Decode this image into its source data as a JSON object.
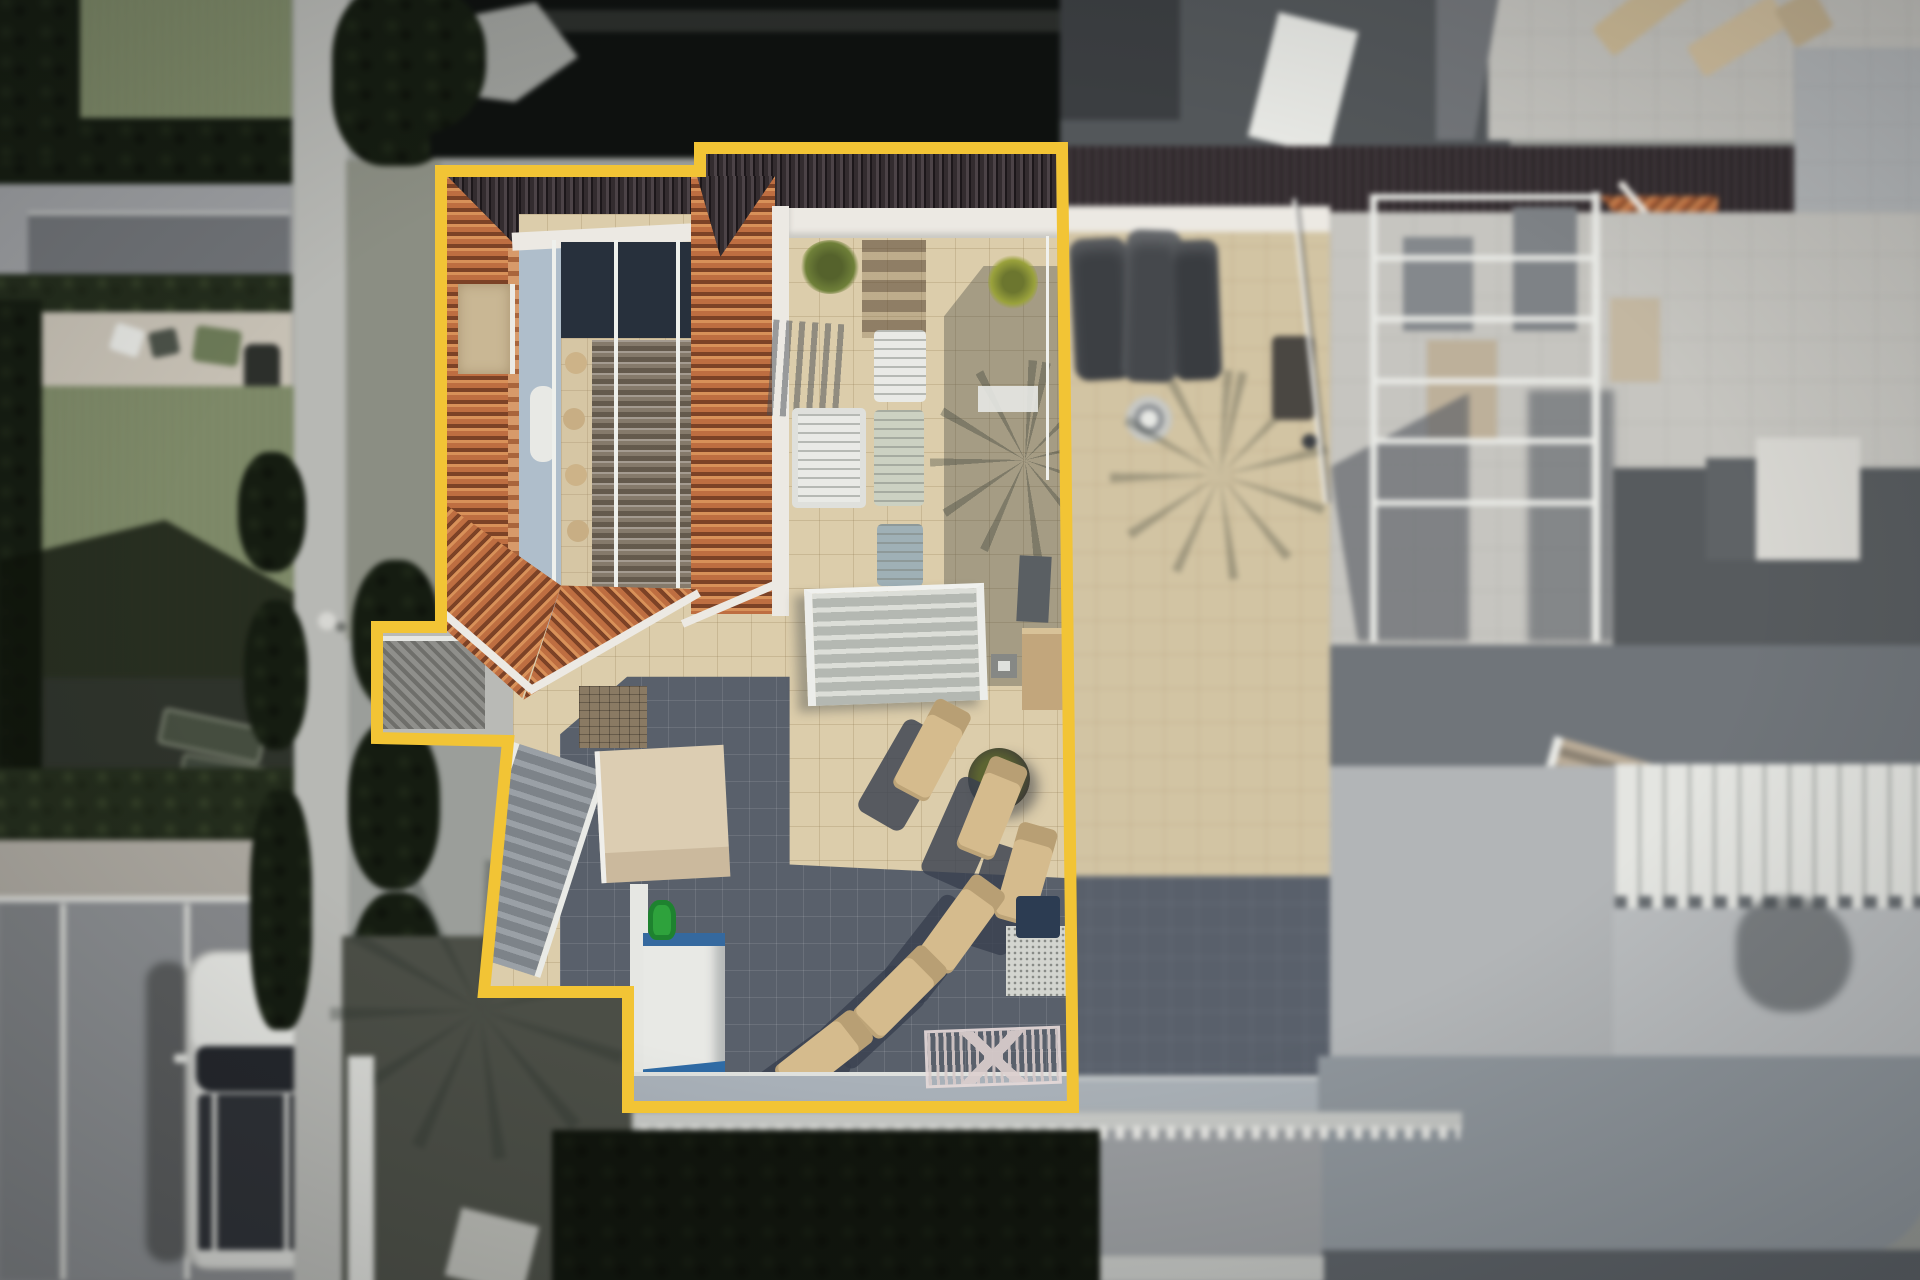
{
  "scene": {
    "type": "aerial-drone-photograph",
    "description": "Top-down aerial view of a villa with a terracotta tiled roof, interior courtyard skylight and a large beige roof terrace with sun loungers; the property parcel is traced with a thick yellow boundary line. Surrounding neighbouring rooftops, gardens, hedges, a parking area with a white car and grey paved terraces are blurred.",
    "objects": [
      "property-boundary",
      "terracotta-hip-roof",
      "dark-ridge-roof",
      "courtyard-skylight",
      "courtyard-staircase",
      "roof-terrace",
      "sun-lounger-fan",
      "vertical-loungers",
      "white-armchair",
      "plant-pots",
      "palm-shadows",
      "mid-terrace-staircase",
      "lower-shaded-terrace",
      "storage-box",
      "clothes-airer",
      "outdoor-kitchen",
      "watering-can",
      "slatted-pergola",
      "garden-stairs",
      "white-car",
      "parking-bays",
      "lawns",
      "hedges",
      "footpath",
      "neighbour-covered-furniture",
      "neighbour-round-table",
      "neighbour-pergola",
      "neighbour-roof-corner",
      "white-louvre-roof",
      "driveway"
    ]
  },
  "palette": {
    "boundary": "#F2C435",
    "roofDark": "#332C2F",
    "roofDarkRib": "#4C4347",
    "terracotta": "#BE6E41",
    "terracottaDark": "#7C4226",
    "terracottaLight": "#D89159",
    "fascia": "#ECE9E3",
    "courtyardWall": "#AFBECB",
    "courtyardDark": "#27303C",
    "courtyardFloor": "#D6C6A4",
    "terrace": "#DCCDAB",
    "terraceDark": "#59606B",
    "loungerTan": "#D5BB8D",
    "shadow": "#39414F",
    "white": "#E9EAE6",
    "lawn": "#7F8B69",
    "hedge": "#232C1C",
    "hedgeDark": "#151C11",
    "gardenShadow": "#0E110F",
    "path": "#B7B8B4",
    "drive": "#87898C",
    "carBody": "#DDDEDA",
    "carGlass": "#24272C",
    "pavingRight": "#A8ACAF",
    "pavingLight": "#C8C7C2",
    "roofGrey": "#53575A",
    "neighborBeige": "#D6C8A7",
    "bigDrive": "#8F969C",
    "whiteRib": "#E4E5E1",
    "blueTrim": "#35699F",
    "greenCan": "#2EA23C",
    "plantGreen": "#6F8039",
    "plantYellow": "#9AA23C"
  },
  "boundary": {
    "points": "441,171 700,171 700,148 1062,148 1073,1107 628,1107 628,992 484,992 508,741 377,738 377,627 441,627",
    "stroke_width": 12
  },
  "furniture": {
    "sun_loungers": [
      {
        "x": 912,
        "y": 700,
        "r": 28
      },
      {
        "x": 972,
        "y": 758,
        "r": 22
      },
      {
        "x": 1006,
        "y": 824,
        "r": 16
      },
      {
        "x": 942,
        "y": 874,
        "r": 36
      },
      {
        "x": 880,
        "y": 942,
        "r": 45
      },
      {
        "x": 804,
        "y": 1004,
        "r": 52
      }
    ],
    "lounger_shadows": [
      {
        "x": 878,
        "y": 722,
        "r": 30
      },
      {
        "x": 938,
        "y": 780,
        "r": 24
      },
      {
        "x": 972,
        "y": 846,
        "r": 18
      },
      {
        "x": 908,
        "y": 896,
        "r": 38
      },
      {
        "x": 846,
        "y": 964,
        "r": 47
      },
      {
        "x": 770,
        "y": 1026,
        "r": 54
      }
    ]
  }
}
